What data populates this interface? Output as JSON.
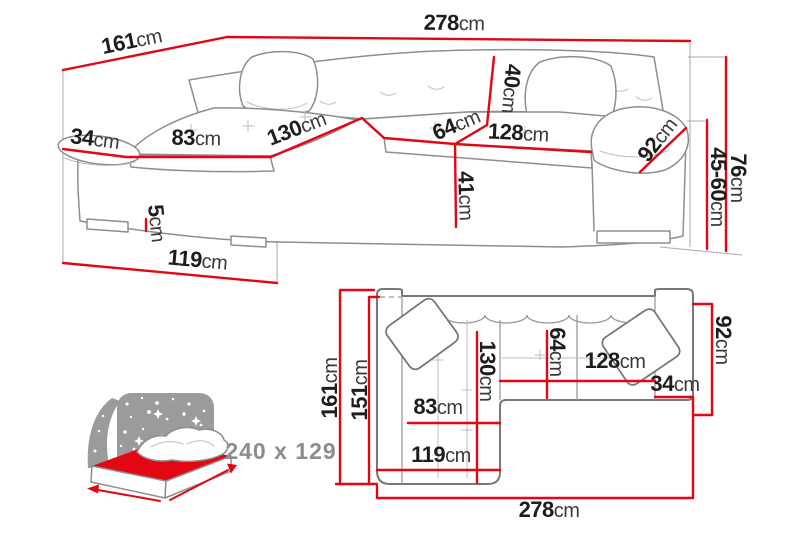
{
  "colors": {
    "dimension_line": "#e30613",
    "sketch_outline": "#8e8e8e",
    "plan_outline": "#787878",
    "label_number": "#1d1d1b",
    "label_unit": "#3a3a39",
    "muted_label": "#8d8d8d",
    "icon_gray": "#9b9b9b",
    "mattress_red": "#e30613"
  },
  "perspective_view": {
    "dims": {
      "total_width": {
        "value": "278",
        "unit": "cm"
      },
      "total_depth": {
        "value": "161",
        "unit": "cm"
      },
      "left_armrest_width": {
        "value": "34",
        "unit": "cm"
      },
      "chaise_seat_width": {
        "value": "83",
        "unit": "cm"
      },
      "chaise_length": {
        "value": "130",
        "unit": "cm"
      },
      "seat_depth": {
        "value": "64",
        "unit": "cm"
      },
      "seat_width": {
        "value": "128",
        "unit": "cm"
      },
      "backrest_cushion_height": {
        "value": "40",
        "unit": "cm"
      },
      "right_armrest_length": {
        "value": "92",
        "unit": "cm"
      },
      "seat_height": {
        "value": "41",
        "unit": "cm"
      },
      "leg_height": {
        "value": "5",
        "unit": "cm"
      },
      "chaise_outer_length": {
        "value": "119",
        "unit": "cm"
      },
      "total_height": {
        "value": "76",
        "unit": "cm"
      },
      "armrest_height": {
        "value": "45-60",
        "unit": "cm"
      }
    }
  },
  "top_view": {
    "dims": {
      "total_depth": {
        "value": "161",
        "unit": "cm"
      },
      "inner_depth": {
        "value": "151",
        "unit": "cm"
      },
      "chaise_length": {
        "value": "130",
        "unit": "cm"
      },
      "seat_depth": {
        "value": "64",
        "unit": "cm"
      },
      "seat_width": {
        "value": "128",
        "unit": "cm"
      },
      "right_armrest_width": {
        "value": "34",
        "unit": "cm"
      },
      "right_side_depth": {
        "value": "92",
        "unit": "cm"
      },
      "chaise_seat_width": {
        "value": "83",
        "unit": "cm"
      },
      "chaise_outer_length": {
        "value": "119",
        "unit": "cm"
      },
      "total_width": {
        "value": "278",
        "unit": "cm"
      }
    }
  },
  "sleeping_function": {
    "area_label": "240 x 129"
  }
}
